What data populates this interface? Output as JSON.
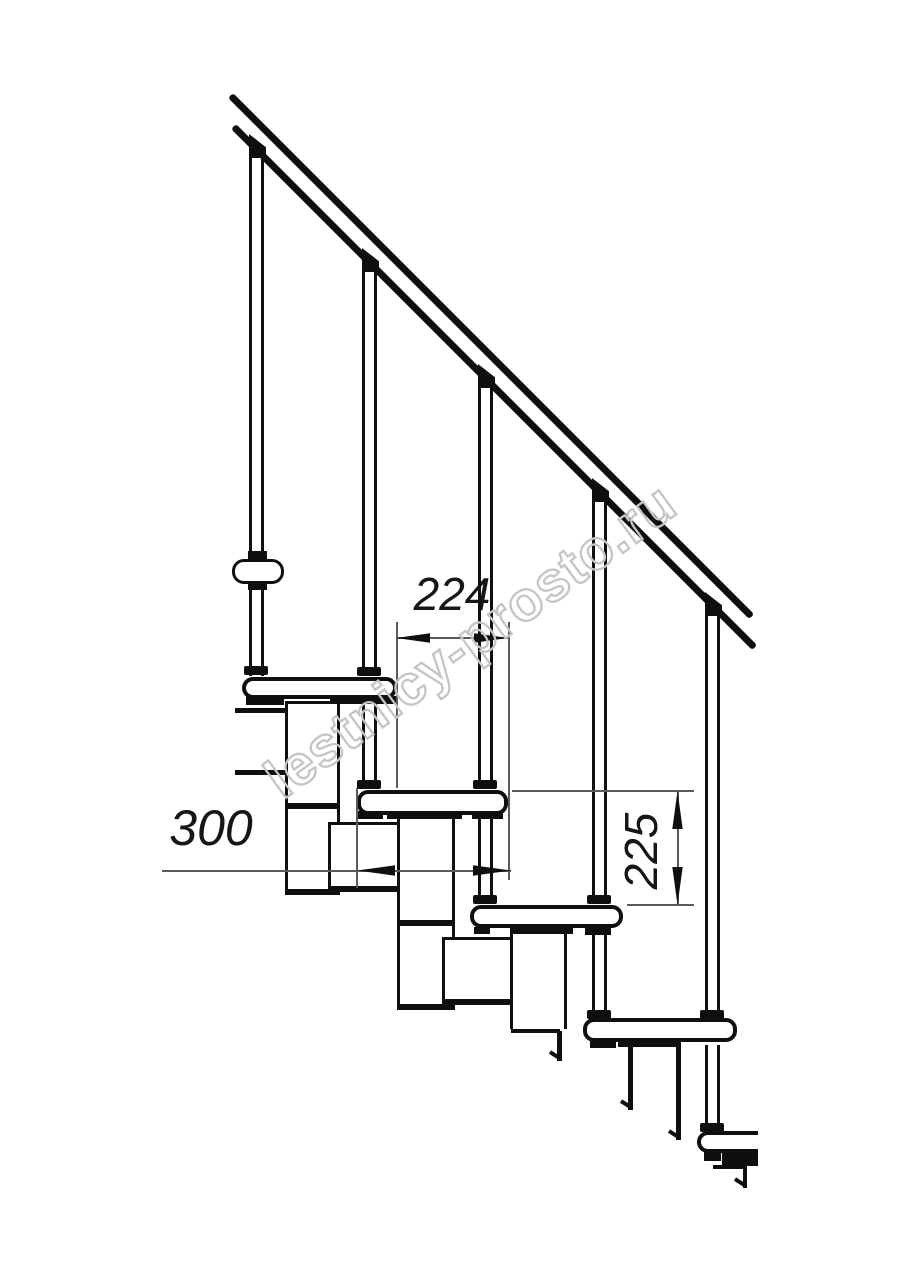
{
  "drawing": {
    "watermark_text": "lestnicy-prosto.ru",
    "dimension_labels": {
      "step_going_horizontal": "224",
      "tread_depth_horizontal": "300",
      "step_rise_vertical": "225"
    },
    "colors": {
      "drawing_lines": "#0f0f0f",
      "dimension_lines": "#5a5a5a",
      "watermark": "#c5c5c5",
      "background": "#ffffff"
    },
    "element_counts": {
      "treads": 5,
      "balusters": 5,
      "handrail_lines": 2
    }
  }
}
